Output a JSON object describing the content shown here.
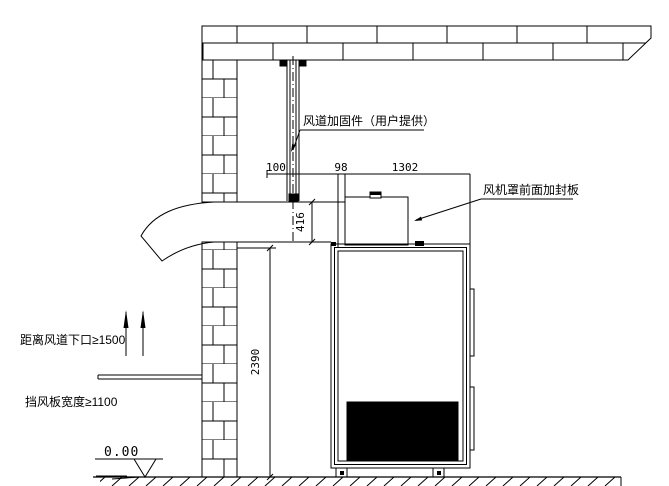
{
  "drawing": {
    "annotations": {
      "duct_reinforcement_label": "风道加固件（用户提供）",
      "fan_hood_panel_label": "风机罩前面加封板",
      "duct_outlet_distance_note": "距离风道下口≥1500",
      "wind_baffle_width_note": "挡风板宽度≥1100",
      "ground_elevation": "0.00"
    },
    "dimensions": {
      "duct_pipe_width": "100",
      "hood_gap": "98",
      "hood_front_span": "1302",
      "duct_height": "416",
      "unit_height": "2390"
    },
    "colors": {
      "line": "#000000",
      "filled_parts": "#000000",
      "background": "#ffffff"
    }
  }
}
